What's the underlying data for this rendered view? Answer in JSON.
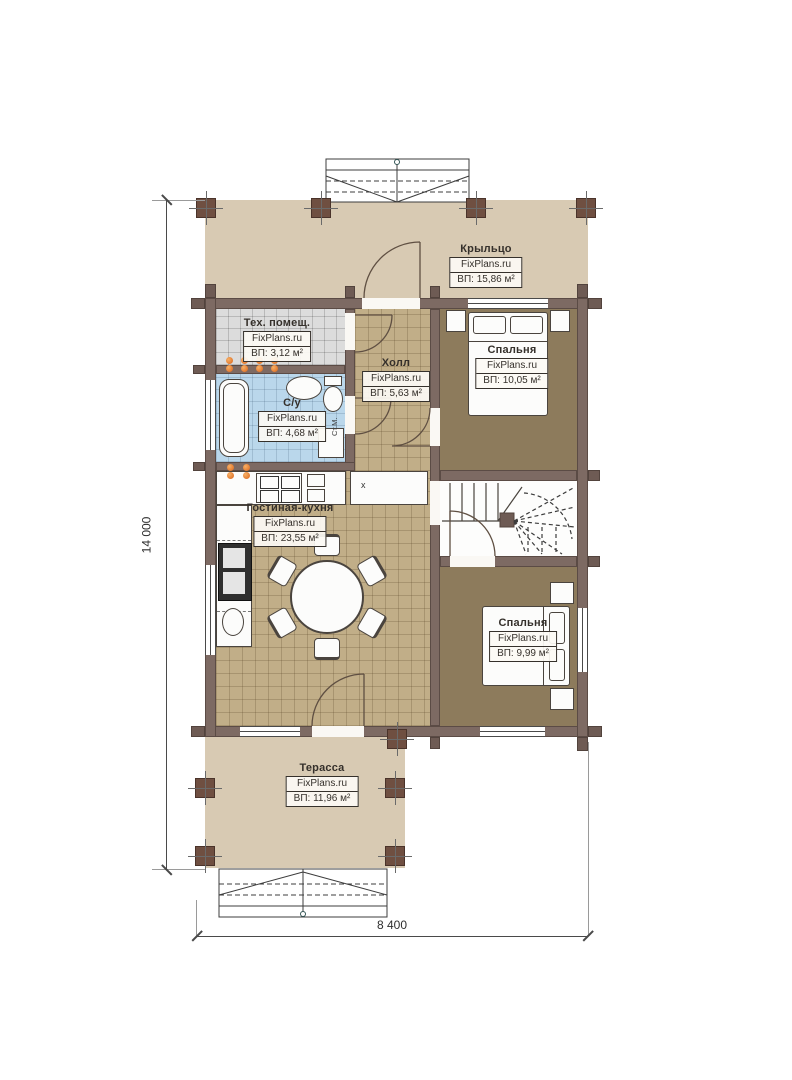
{
  "rooms": {
    "porch": {
      "name": "Крыльцо",
      "brand": "FixPlans.ru",
      "area": "ВП: 15,86 м²"
    },
    "tech": {
      "name": "Тех. помещ.",
      "brand": "FixPlans.ru",
      "area": "ВП: 3,12 м²"
    },
    "hall": {
      "name": "Холл",
      "brand": "FixPlans.ru",
      "area": "ВП: 5,63 м²"
    },
    "bathroom": {
      "name": "С/у",
      "brand": "FixPlans.ru",
      "area": "ВП: 4,68 м²"
    },
    "bedroom1": {
      "name": "Спальня",
      "brand": "FixPlans.ru",
      "area": "ВП: 10,05 м²"
    },
    "living_kitchen": {
      "name": "Гостиная-кухня",
      "brand": "FixPlans.ru",
      "area": "ВП: 23,55 м²"
    },
    "bedroom2": {
      "name": "Спальня",
      "brand": "FixPlans.ru",
      "area": "ВП: 9,99 м²"
    },
    "terrace": {
      "name": "Терасса",
      "brand": "FixPlans.ru",
      "area": "ВП: 11,96 м²"
    }
  },
  "dimensions": {
    "height": "14 000",
    "width": "8 400"
  },
  "annotations": {
    "washing_machine": "Ст.М.",
    "kitchen_cabinet": "x"
  },
  "colors": {
    "wall": "#7d6a63",
    "porch_floor": "#d8cab3",
    "hall_floor": "#c1ae88",
    "bedroom_floor": "#8d7b5c",
    "tech_floor": "#dcdcdc",
    "bath_floor": "#bad7eb",
    "radiator": "#d9641a",
    "post": "#6f4f41"
  }
}
